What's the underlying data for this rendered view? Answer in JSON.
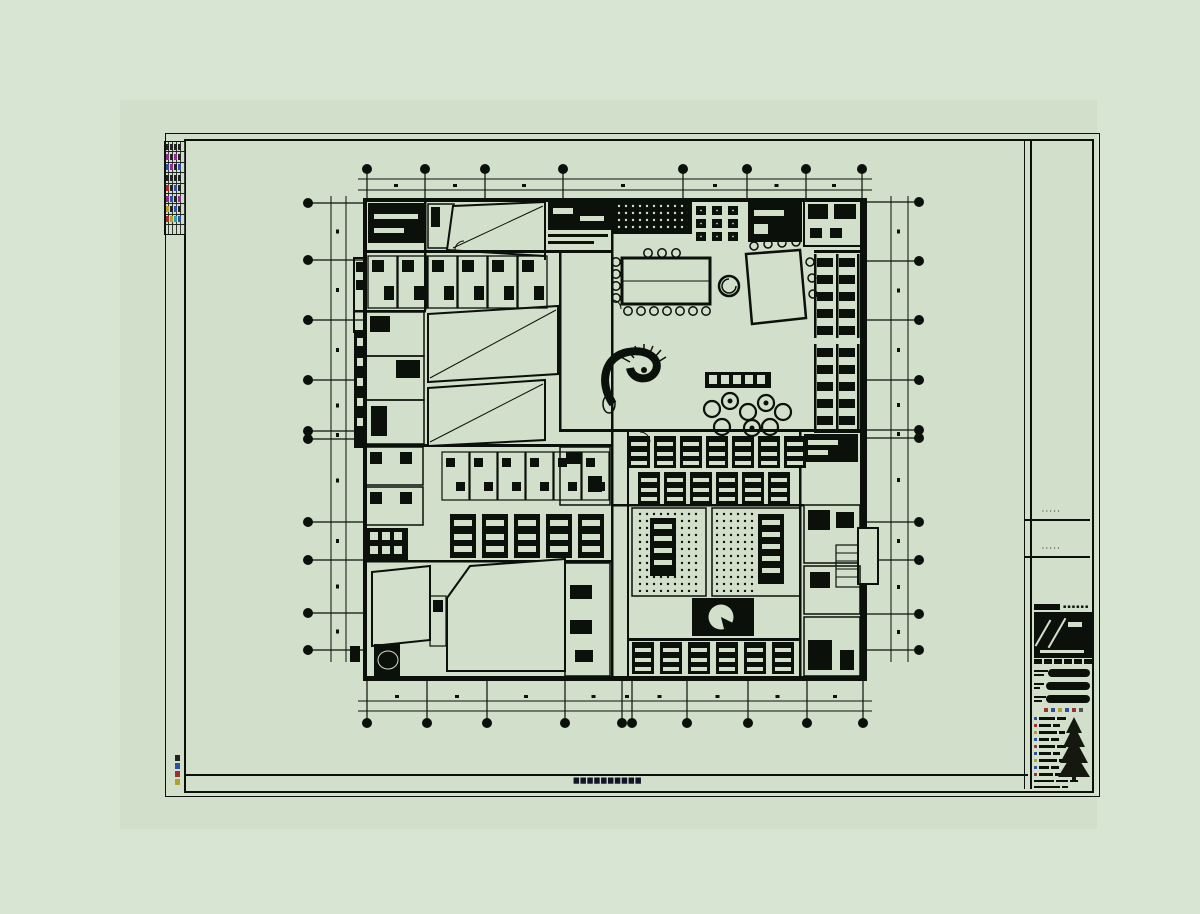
{
  "meta": {
    "description": "Architectural CAD floor-plan sheet displayed on a green drawing background"
  },
  "colors": {
    "outer_bg": "#d9e5d3",
    "page_bg": "#d2dfca",
    "ink": "#0b100a",
    "caption_ink": "#141428",
    "accent_red": "#a03030",
    "accent_blue": "#2f4fa0",
    "accent_yellow": "#b0a030",
    "accent_magenta": "#8b2f8b",
    "accent_cyan": "#2f9fa0",
    "accent_dark": "#222222"
  },
  "sheet": {
    "footer_caption": "▆▆▆▆▆▆▆▆▆▆",
    "side_note_blocks": [
      "#222222",
      "#2f4fa0",
      "#a03030",
      "#b0a030"
    ],
    "revision_table_rows": [
      [
        "#222222",
        "#222222",
        "#222222",
        "#222222"
      ],
      [
        "#8b2f8b",
        "#222222",
        "#8b2f8b",
        "#222222"
      ],
      [
        "#2f4fa0",
        "#8b2f8b",
        "#222222",
        "#2f4fa0"
      ],
      [
        "#222222",
        "#222222",
        "#222222",
        "#222222"
      ],
      [
        "#a03030",
        "#222222",
        "#2f4fa0",
        "#222222"
      ],
      [
        "#8b2f8b",
        "#2f4fa0",
        "#222222",
        "#8b2f8b"
      ],
      [
        "#b0a030",
        "#222222",
        "#2f4fa0",
        "#222222"
      ],
      [
        "#a03030",
        "#b0a030",
        "#2f9fa0",
        "#2f4fa0"
      ]
    ]
  },
  "title_block": {
    "note_rows": [
      "·····",
      "·····"
    ],
    "company_bar_glyphs": "▪▪▪▪▪▪",
    "field_rows": [
      {
        "label_w": 14,
        "pill_w": 44
      },
      {
        "label_w": 10,
        "pill_w": 44
      },
      {
        "label_w": 12,
        "pill_w": 44
      }
    ],
    "stamp_dots": [
      "#a03030",
      "#2f4fa0",
      "#b0a030",
      "#2f4fa0",
      "#a03030",
      "#555555"
    ],
    "list_rows": [
      {
        "chip": "#2f4fa0",
        "segs": [
          16,
          9
        ]
      },
      {
        "chip": "#a03030",
        "segs": [
          12,
          7
        ]
      },
      {
        "chip": "#b0a030",
        "segs": [
          18,
          6
        ]
      },
      {
        "chip": "#2f4fa0",
        "segs": [
          10,
          8
        ]
      },
      {
        "chip": "#a03030",
        "segs": [
          16,
          9
        ]
      },
      {
        "chip": "#2f4fa0",
        "segs": [
          12,
          7
        ]
      },
      {
        "chip": "#b0a030",
        "segs": [
          18,
          6
        ]
      },
      {
        "chip": "#2f4fa0",
        "segs": [
          10,
          8
        ]
      },
      {
        "chip": "#a03030",
        "segs": [
          14,
          8
        ]
      }
    ],
    "footer_rows": [
      {
        "segs": [
          20,
          12,
          8
        ]
      },
      {
        "segs": [
          26,
          6
        ]
      }
    ]
  },
  "plan": {
    "grid": {
      "bubble_r": 5,
      "top_x": [
        367,
        425,
        485,
        563,
        683,
        747,
        806,
        862
      ],
      "bottom_x": [
        367,
        427,
        487,
        565,
        622,
        632,
        687,
        748,
        807,
        863
      ],
      "left_y": [
        203,
        260,
        320,
        380,
        431,
        439,
        522,
        560,
        613,
        650
      ],
      "right_y": [
        202,
        261,
        320,
        380,
        430,
        438,
        522,
        560,
        614,
        650
      ],
      "top": {
        "bubble_cy": 169,
        "dim1": 179,
        "dim2": 190,
        "edge": 198,
        "span": [
          358,
          872
        ]
      },
      "bottom": {
        "bubble_cy": 723,
        "dim1": 701,
        "dim2": 711,
        "edge": 681,
        "span": [
          358,
          872
        ]
      },
      "left": {
        "bubble_cx": 308,
        "dim1": 331,
        "dim2": 346,
        "edge": 363,
        "span": [
          196,
          662
        ]
      },
      "right": {
        "bubble_cx": 919,
        "dim1": 891,
        "dim2": 908,
        "edge": 867,
        "span": [
          196,
          662
        ]
      }
    }
  }
}
